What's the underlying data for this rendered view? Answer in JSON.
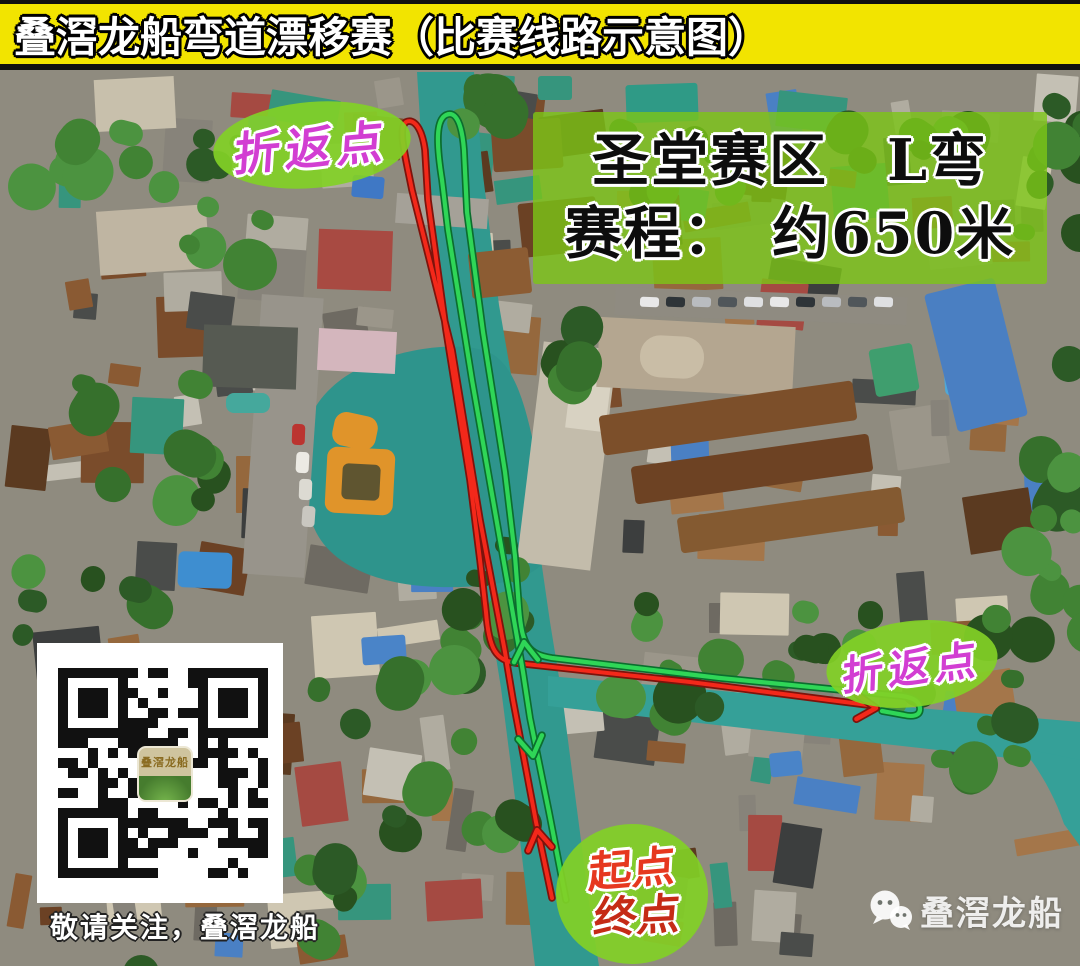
{
  "title_bar": {
    "text": "叠滘龙船弯道漂移赛（比赛线路示意图）"
  },
  "info_box": {
    "line1": "圣堂赛区　L弯",
    "line2": "赛程：　约650米"
  },
  "badges": {
    "turnaround_top": "折返点",
    "turnaround_right": "折返点",
    "start": "起点",
    "finish": "终点"
  },
  "qr": {
    "caption": "敬请关注，叠滘龙船",
    "logo_text": "叠滘龙船"
  },
  "watermark": {
    "text": "叠滘龙船",
    "icon": "wechat-icon"
  },
  "colors": {
    "title_bg": "#f2e400",
    "overlay_green": "#7cc616",
    "turnaround_text": "#d23ed2",
    "start_finish_text": "#e6381f",
    "route_red": "#f3281a",
    "route_green": "#2fd657",
    "water": "#31998f"
  }
}
